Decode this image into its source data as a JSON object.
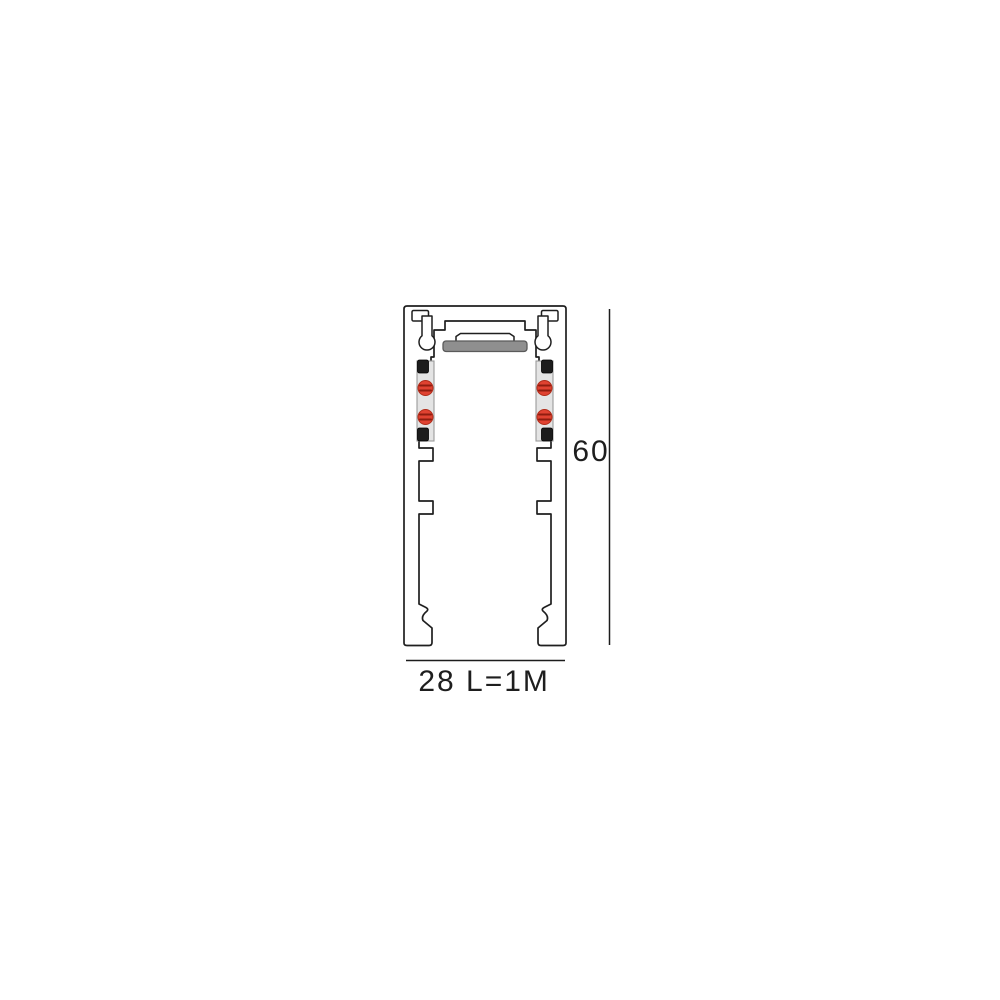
{
  "drawing": {
    "type": "track-profile-cross-section",
    "dimensions": {
      "height_label": "60",
      "width_label": "28",
      "length_label": "L=1M"
    },
    "colors": {
      "outline": "#1f1f1f",
      "magnet_bar_fill": "#8f8f8f",
      "magnet_bar_border": "#5a5a5a",
      "contact_strip_fill": "#e4e4e4",
      "contact_strip_border": "#9a9a9a",
      "contact_red": "#e04231",
      "contact_red_border": "#b02c1a",
      "contact_slot_dark": "#8f1d10",
      "clip_black": "#1c1c1c"
    }
  }
}
